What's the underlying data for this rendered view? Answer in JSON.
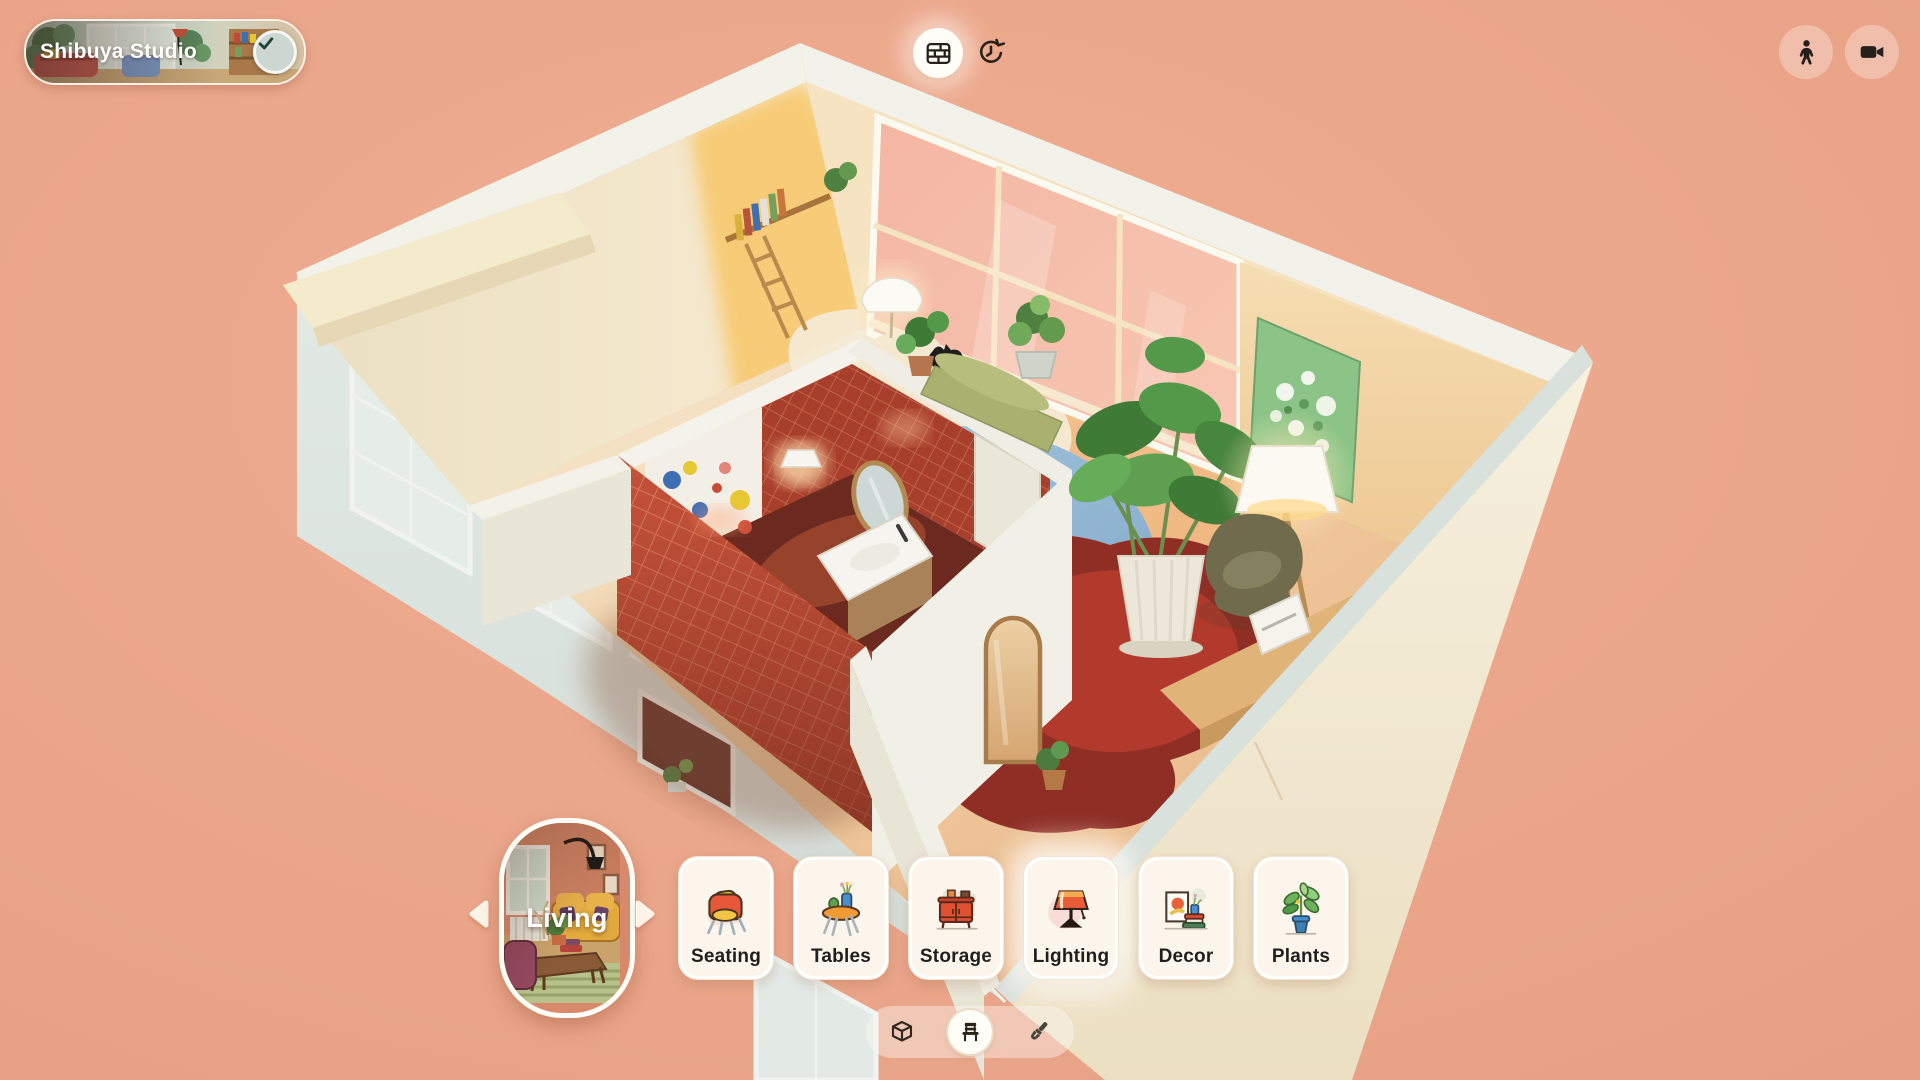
{
  "header": {
    "project_pill": {
      "name": "Shibuya Studio",
      "badge_icon": "check"
    },
    "view_buttons": [
      {
        "icon": "brick-wall",
        "state": "active"
      },
      {
        "icon": "history-clock",
        "state": "default"
      }
    ],
    "utility_buttons": [
      {
        "icon": "person-walk"
      },
      {
        "icon": "video-camera"
      }
    ]
  },
  "category_bar": {
    "prev_icon": "chevron-left",
    "next_icon": "chevron-right",
    "selected_category": {
      "label": "Living"
    },
    "categories": [
      {
        "label": "Seating",
        "icon": "armchair"
      },
      {
        "label": "Tables",
        "icon": "round-table"
      },
      {
        "label": "Storage",
        "icon": "sideboard"
      },
      {
        "label": "Lighting",
        "icon": "table-lamp",
        "highlighted": true
      },
      {
        "label": "Decor",
        "icon": "frame-and-books"
      },
      {
        "label": "Plants",
        "icon": "potted-plant"
      }
    ]
  },
  "mode_toolbar": {
    "modes": [
      {
        "icon": "cube-3d",
        "active": false
      },
      {
        "icon": "chair",
        "active": true
      },
      {
        "icon": "paintbrush",
        "active": false
      }
    ]
  },
  "scene": {
    "type": "isometric cutaway studio apartment",
    "rooms": [
      "bedroom",
      "bathroom",
      "living area"
    ],
    "visible_objects": [
      "blue bed",
      "white dome bedside lamp",
      "black cat",
      "potted plants",
      "wall bookshelf with ladder",
      "red mosaic tiled bathroom",
      "bathroom sink",
      "oval bathroom mirror",
      "colorful bathroom mural",
      "pink glass window wall",
      "green window bench",
      "monstera plant in ribbed pot",
      "tripod floor lamp",
      "green floral painting",
      "olive armchair",
      "red organic rug",
      "wooden desk",
      "white printer",
      "arched floor mirror"
    ]
  },
  "colors": {
    "background": "#eba88d",
    "card_background": "#fcf5eb",
    "card_inner_ring": "#ffffff",
    "label_text": "#1f1f1f",
    "tile_red": "#c6523a",
    "glass_pink": "#f4bba6",
    "interior_cream": "#efe4c8",
    "exterior_wall": "#dde5e0",
    "accent_white": "#fffdf6"
  }
}
